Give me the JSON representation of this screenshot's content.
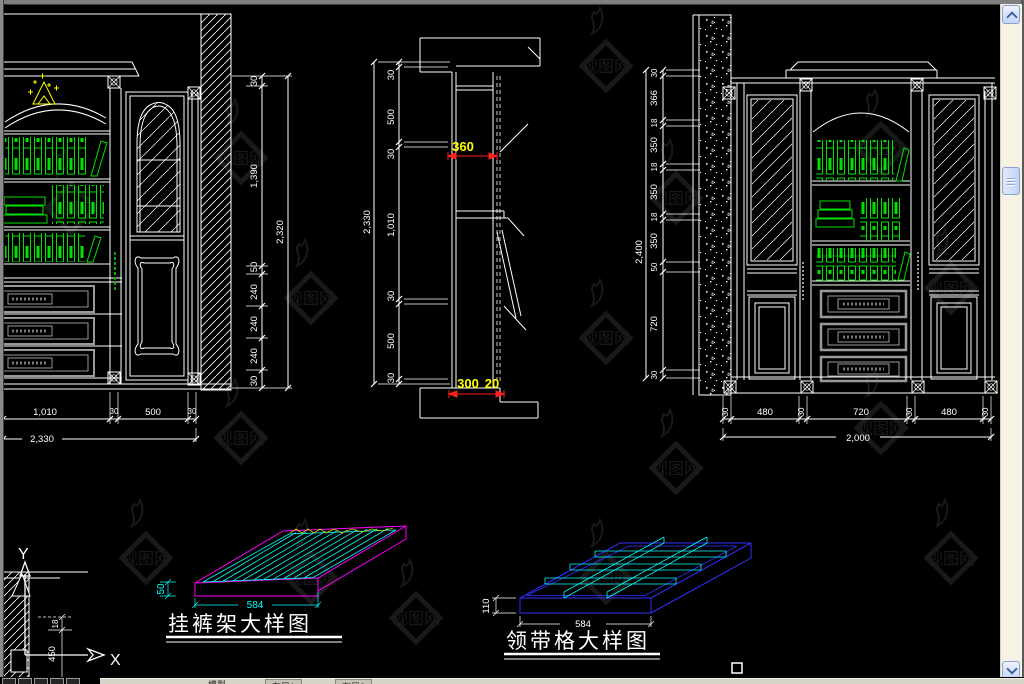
{
  "left_elevation": {
    "dims_right": [
      "30",
      "1,390",
      "50",
      "240",
      "240",
      "240",
      "30"
    ],
    "dim_right_total": "2,320",
    "dims_bottom": [
      "1,010",
      "30",
      "500",
      "30"
    ],
    "dim_bottom_total": "2,330"
  },
  "section": {
    "dims_left": [
      "30",
      "500",
      "30",
      "1,010",
      "30",
      "500",
      "30"
    ],
    "dim_left_total": "2,330",
    "dim_shelf_width": "360",
    "dim_base_width": "300",
    "dim_base_toe": "20"
  },
  "right_elevation": {
    "dims_left": [
      "30",
      "366",
      "18",
      "350",
      "18",
      "350",
      "18",
      "350",
      "50",
      "720",
      "30"
    ],
    "dim_left_total": "2,400",
    "dims_bottom": [
      "30",
      "480",
      "30",
      "720",
      "30",
      "480",
      "30"
    ],
    "dim_bottom_total": "2,000"
  },
  "trouser_rack": {
    "title": "挂裤架大样图",
    "dim_width": "584",
    "dim_depth": "50"
  },
  "tie_grid": {
    "title": "领带格大样图",
    "dim_width": "584",
    "dim_depth": "110"
  },
  "ucs": {
    "x_label": "X",
    "y_label": "Y"
  },
  "corner_detail": {
    "dim_top": "18",
    "dim_bottom": "450"
  },
  "tab_bar": {
    "model": "模型",
    "layout1": "布局1",
    "layout2": "布局2"
  },
  "watermark": {
    "text": "视图网"
  }
}
